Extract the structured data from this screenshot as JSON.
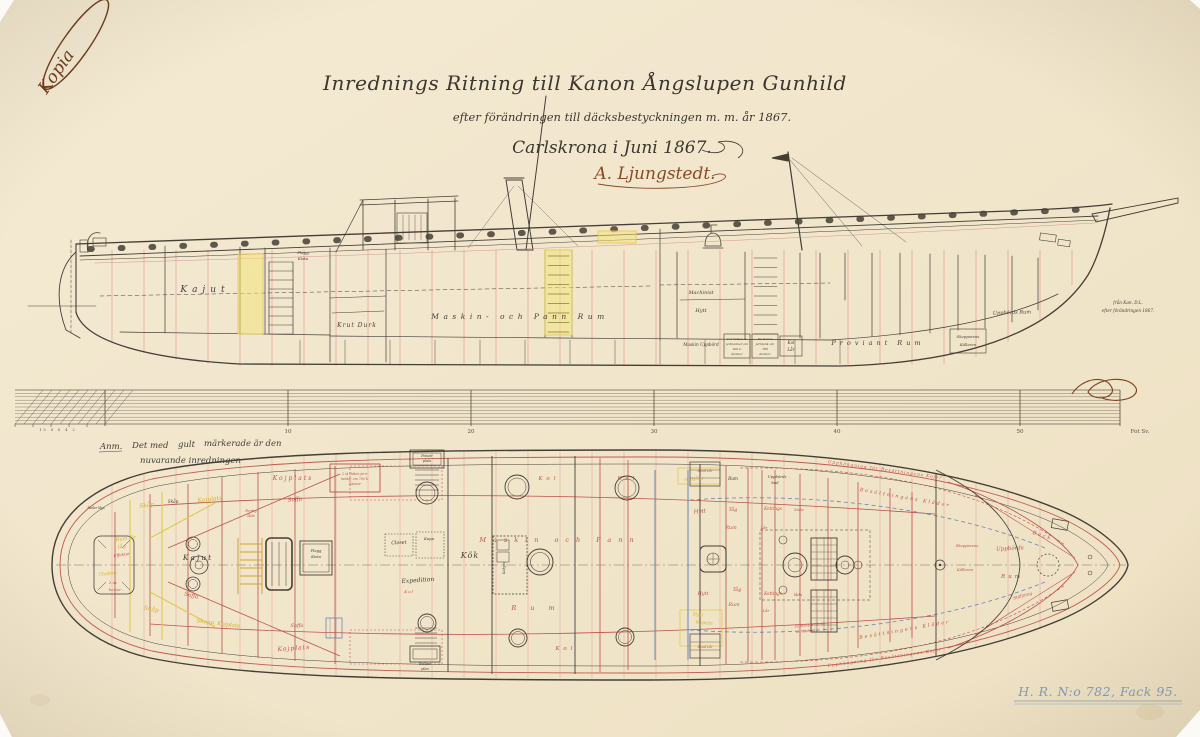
{
  "stamp": {
    "text": "Kopia"
  },
  "title_block": {
    "line1": "Inrednings Ritning till Kanon Ångslupen Gunhild",
    "line2": "efter förändringen till däcksbestyckningen m. m. år 1867.",
    "line3": "Carlskrona i Juni 1867.",
    "signature": "A. Ljungstedt."
  },
  "note": {
    "label": "Anm.",
    "line1_pre": "Det med",
    "highlight": "gult",
    "line1_post": "märkerade är den",
    "line2": "nuvarande inredningen"
  },
  "scale": {
    "ticks": [
      "10",
      "20",
      "30",
      "40",
      "50"
    ],
    "minor": "10 8 6 4 2",
    "end_label": "Fot Sv."
  },
  "archive": {
    "text": "H. R. N:o 782, Fack 95."
  },
  "colors": {
    "paper": "#f1e6cc",
    "ink": "#443e35",
    "red": "#bf5049",
    "yellow": "#d9ba35",
    "blue": "#6d84b0",
    "archive_blue": "#7f9cbd",
    "stamp_brown": "#6f3a1d"
  },
  "side_view": {
    "labels": [
      {
        "t": "Kajut",
        "x": 205,
        "y": 292,
        "s": 9,
        "ls": 5
      },
      {
        "t": "Flagg",
        "x": 303,
        "y": 254,
        "s": 4
      },
      {
        "t": "Kista",
        "x": 303,
        "y": 260,
        "s": 4
      },
      {
        "t": "Krut Durk",
        "x": 357,
        "y": 327,
        "s": 6,
        "ls": 1
      },
      {
        "t": "Maskin- och Pann Rum",
        "x": 520,
        "y": 319,
        "s": 7.5,
        "ls": 4.5
      },
      {
        "t": "Machinist",
        "x": 701,
        "y": 294,
        "s": 5
      },
      {
        "t": "Hytt",
        "x": 701,
        "y": 312,
        "s": 5
      },
      {
        "t": "Maskin Uppbörd",
        "x": 701,
        "y": 346,
        "s": 4.2
      },
      {
        "t": "2 st Vatten R.",
        "x": 737,
        "y": 340,
        "s": 3
      },
      {
        "t": "jerntankar om",
        "x": 737,
        "y": 345,
        "s": 3
      },
      {
        "t": "100 k.",
        "x": 737,
        "y": 350,
        "s": 3
      },
      {
        "t": "Kannor",
        "x": 737,
        "y": 355,
        "s": 3
      },
      {
        "t": "En Vatten",
        "x": 765,
        "y": 340,
        "s": 3
      },
      {
        "t": "jerntank om",
        "x": 765,
        "y": 345,
        "s": 3
      },
      {
        "t": "785",
        "x": 765,
        "y": 350,
        "s": 3
      },
      {
        "t": "Kannor",
        "x": 765,
        "y": 355,
        "s": 3
      },
      {
        "t": "Kol",
        "x": 791,
        "y": 344,
        "s": 4.2
      },
      {
        "t": "Lår",
        "x": 791,
        "y": 351,
        "s": 4.2
      },
      {
        "t": "Proviant Rum",
        "x": 878,
        "y": 345,
        "s": 6.5,
        "ls": 4
      },
      {
        "t": "Skepparens",
        "x": 968,
        "y": 338,
        "s": 3.8
      },
      {
        "t": "Källaren",
        "x": 968,
        "y": 346,
        "s": 3.8
      },
      {
        "t": "Uppbörds Rum",
        "x": 1012,
        "y": 314,
        "s": 5,
        "rot": -2
      },
      {
        "t": "från Kan. D.L.",
        "x": 1128,
        "y": 304,
        "s": 4.2
      },
      {
        "t": "efter förändringen 1867.",
        "x": 1128,
        "y": 312,
        "s": 4.2
      }
    ]
  },
  "plan_view": {
    "labels": [
      {
        "t": "Roder klys",
        "x": 96,
        "y": 509,
        "s": 3.2
      },
      {
        "t": "Rum för",
        "x": 126,
        "y": 540,
        "s": 5,
        "c": "yellow",
        "rot": -8
      },
      {
        "t": "tåg",
        "x": 122,
        "y": 548,
        "s": 5,
        "c": "yellow",
        "rot": -8
      },
      {
        "t": "Effekter",
        "x": 122,
        "y": 556,
        "s": 4,
        "c": "red",
        "rot": -8
      },
      {
        "t": "Chefens",
        "x": 108,
        "y": 575,
        "s": 4.5,
        "c": "yellow",
        "rot": -5
      },
      {
        "t": "2 ne",
        "x": 113,
        "y": 584,
        "s": 3.8,
        "c": "red"
      },
      {
        "t": "luckor",
        "x": 115,
        "y": 591,
        "s": 3.8,
        "c": "red"
      },
      {
        "t": "Skåp",
        "x": 147,
        "y": 507,
        "s": 6,
        "c": "yellow",
        "rot": -8
      },
      {
        "t": "Skåp",
        "x": 173,
        "y": 503,
        "s": 4.2
      },
      {
        "t": "Kojplats",
        "x": 210,
        "y": 501,
        "s": 6,
        "c": "yellow",
        "rot": -6
      },
      {
        "t": "Kojplats",
        "x": 293,
        "y": 480,
        "s": 6,
        "c": "red",
        "ls": 2
      },
      {
        "t": "Soffa",
        "x": 295,
        "y": 501,
        "s": 5.5,
        "c": "red",
        "rot": -5
      },
      {
        "t": "Kajut",
        "x": 198,
        "y": 560,
        "s": 7.5,
        "ls": 2
      },
      {
        "t": "Soffa",
        "x": 191,
        "y": 597,
        "s": 5.5,
        "c": "red",
        "rot": 14
      },
      {
        "t": "Skåp",
        "x": 151,
        "y": 611,
        "s": 6,
        "c": "yellow",
        "rot": 10
      },
      {
        "t": "Skepp. Kojplats",
        "x": 218,
        "y": 625,
        "s": 5.5,
        "c": "yellow",
        "rot": 7
      },
      {
        "t": "Kojplats",
        "x": 294,
        "y": 650,
        "s": 6,
        "c": "red",
        "rot": -4,
        "ls": 1
      },
      {
        "t": "Soffa",
        "x": 297,
        "y": 627,
        "s": 5,
        "c": "red"
      },
      {
        "t": "Flagg",
        "x": 316,
        "y": 552,
        "s": 3.8
      },
      {
        "t": "Kista",
        "x": 316,
        "y": 558,
        "s": 3.8
      },
      {
        "t": "Pentry",
        "x": 251,
        "y": 512,
        "s": 3.4,
        "c": "red"
      },
      {
        "t": "låda",
        "x": 251,
        "y": 517,
        "s": 3.4,
        "c": "red"
      },
      {
        "t": "2 st Vatten jern-",
        "x": 355,
        "y": 475,
        "s": 3.2,
        "c": "red"
      },
      {
        "t": "tankar om 700 k.",
        "x": 355,
        "y": 480,
        "s": 3.2,
        "c": "red"
      },
      {
        "t": "Kannor",
        "x": 355,
        "y": 485,
        "s": 3.2,
        "c": "red"
      },
      {
        "t": "Pissoir",
        "x": 427,
        "y": 457,
        "s": 3.4
      },
      {
        "t": "plats",
        "x": 427,
        "y": 462,
        "s": 3.4
      },
      {
        "t": "Closet",
        "x": 399,
        "y": 544,
        "s": 4.8,
        "rot": -3
      },
      {
        "t": "Kapp",
        "x": 429,
        "y": 540,
        "s": 3.8
      },
      {
        "t": "Kök",
        "x": 470,
        "y": 558,
        "s": 8,
        "ls": 1
      },
      {
        "t": "Kabyss",
        "x": 505,
        "y": 568,
        "s": 3.4,
        "rot": -90
      },
      {
        "t": "Expedition",
        "x": 418,
        "y": 582,
        "s": 6,
        "rot": -4
      },
      {
        "t": "Kol",
        "x": 409,
        "y": 593,
        "s": 4,
        "c": "red",
        "ls": 1
      },
      {
        "t": "Ballast",
        "x": 425,
        "y": 665,
        "s": 3.4
      },
      {
        "t": "plan",
        "x": 425,
        "y": 670,
        "s": 3.4
      },
      {
        "t": "Maskin och Pann",
        "x": 560,
        "y": 542,
        "s": 6.5,
        "c": "red",
        "ls": 7
      },
      {
        "t": "Rum",
        "x": 540,
        "y": 610,
        "s": 6.5,
        "c": "red",
        "ls": 14
      },
      {
        "t": "Kol",
        "x": 549,
        "y": 480,
        "s": 5.5,
        "c": "red",
        "ls": 4
      },
      {
        "t": "Kol",
        "x": 628,
        "y": 480,
        "s": 5.5,
        "c": "red",
        "ls": 4
      },
      {
        "t": "Kol",
        "x": 566,
        "y": 650,
        "s": 5.5,
        "c": "red",
        "ls": 4
      },
      {
        "t": "Nedgång",
        "x": 694,
        "y": 480,
        "s": 4.2,
        "c": "yellow",
        "rot": -6
      },
      {
        "t": "Rund Lår",
        "x": 705,
        "y": 472,
        "s": 3.2,
        "c": "red"
      },
      {
        "t": "Rund Lår",
        "x": 705,
        "y": 648,
        "s": 3.2,
        "c": "red"
      },
      {
        "t": "Rum",
        "x": 733,
        "y": 480,
        "s": 4.2
      },
      {
        "t": "Uppbörds",
        "x": 777,
        "y": 478,
        "s": 3.8
      },
      {
        "t": "bod",
        "x": 775,
        "y": 484,
        "s": 3.8
      },
      {
        "t": "Hytt",
        "x": 700,
        "y": 513,
        "s": 5.5,
        "c": "red",
        "rot": -5
      },
      {
        "t": "Hytt",
        "x": 703,
        "y": 595,
        "s": 4.8,
        "c": "red"
      },
      {
        "t": "Hytt",
        "x": 698,
        "y": 616,
        "s": 4.5,
        "c": "yellow",
        "rot": 5
      },
      {
        "t": "Kojplats",
        "x": 704,
        "y": 624,
        "s": 4.2,
        "c": "yellow",
        "rot": 5
      },
      {
        "t": "Tåg",
        "x": 733,
        "y": 511,
        "s": 4.8,
        "c": "red"
      },
      {
        "t": "Rum",
        "x": 731,
        "y": 529,
        "s": 4.8,
        "c": "red"
      },
      {
        "t": "Tåg",
        "x": 737,
        "y": 591,
        "s": 4.8,
        "c": "red"
      },
      {
        "t": "Rum",
        "x": 734,
        "y": 606,
        "s": 4.8,
        "c": "red"
      },
      {
        "t": "Kettings",
        "x": 773,
        "y": 510,
        "s": 4.2,
        "c": "red"
      },
      {
        "t": "kista",
        "x": 799,
        "y": 511,
        "s": 3.8,
        "c": "red"
      },
      {
        "t": "Lår",
        "x": 764,
        "y": 529,
        "s": 3.8,
        "c": "red"
      },
      {
        "t": "Kettings",
        "x": 773,
        "y": 595,
        "s": 4.2,
        "c": "red"
      },
      {
        "t": "låda",
        "x": 798,
        "y": 596,
        "s": 3.8,
        "c": "red"
      },
      {
        "t": "Lår",
        "x": 766,
        "y": 612,
        "s": 3.8,
        "c": "red"
      },
      {
        "t": "Upphängde Lår för",
        "x": 810,
        "y": 626,
        "s": 3.2,
        "c": "red",
        "rot": -6
      },
      {
        "t": "all Uppbörd",
        "x": 806,
        "y": 632,
        "s": 3.2,
        "c": "red",
        "rot": -6
      },
      {
        "t": "Upphängning för Besättningens Kojer",
        "x": 885,
        "y": 471,
        "s": 4.2,
        "c": "red",
        "rot": 8,
        "ls": 1
      },
      {
        "t": "Besättningens Kläder",
        "x": 905,
        "y": 499,
        "s": 4.8,
        "c": "red",
        "rot": 10,
        "ls": 2
      },
      {
        "t": "Upphängning för Besättningens Kojer",
        "x": 885,
        "y": 659,
        "s": 4.2,
        "c": "red",
        "rot": -8,
        "ls": 1
      },
      {
        "t": "Besättningens Kläder",
        "x": 905,
        "y": 631,
        "s": 4.8,
        "c": "red",
        "rot": -10,
        "ls": 2
      },
      {
        "t": "Back",
        "x": 1042,
        "y": 537,
        "s": 5,
        "c": "red",
        "rot": 18,
        "ls": 2
      },
      {
        "t": "Uppbörds",
        "x": 1010,
        "y": 550,
        "s": 5.5,
        "c": "red",
        "rot": -3
      },
      {
        "t": "Rum",
        "x": 1012,
        "y": 578,
        "s": 5.5,
        "c": "red",
        "ls": 3
      },
      {
        "t": "Skepparens",
        "x": 967,
        "y": 547,
        "s": 3.8,
        "c": "red"
      },
      {
        "t": "Källaren",
        "x": 965,
        "y": 571,
        "s": 3.8,
        "c": "red"
      },
      {
        "t": "Ställning",
        "x": 1023,
        "y": 597,
        "s": 4.2,
        "c": "red",
        "rot": -16
      }
    ]
  }
}
